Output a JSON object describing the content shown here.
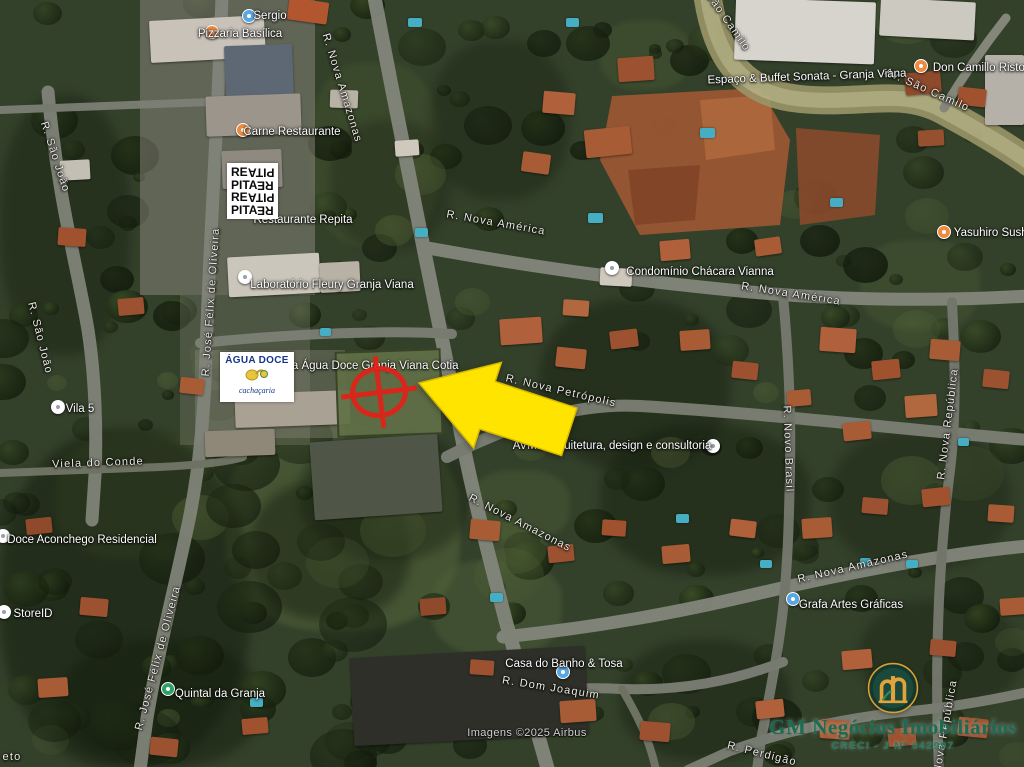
{
  "map": {
    "attribution": "Imagens ©2025 Airbus",
    "street_labels": [
      {
        "text": "R. Nova Amazonas",
        "x": 342,
        "y": 88,
        "rot": 73
      },
      {
        "text": "R. Nova América",
        "x": 496,
        "y": 223,
        "rot": 10
      },
      {
        "text": "R. Nova América",
        "x": 791,
        "y": 294,
        "rot": 9
      },
      {
        "text": "São Camilo",
        "x": 728,
        "y": 22,
        "rot": 55
      },
      {
        "text": "Av. São Camilo",
        "x": 927,
        "y": 90,
        "rot": 24
      },
      {
        "text": "R. Nova Petrópolis",
        "x": 561,
        "y": 391,
        "rot": 13
      },
      {
        "text": "R. Nova Amazonas",
        "x": 520,
        "y": 523,
        "rot": 27
      },
      {
        "text": "R. Nova Amazonas",
        "x": 853,
        "y": 567,
        "rot": -13
      },
      {
        "text": "R. Novo Brasil",
        "x": 788,
        "y": 449,
        "rot": 88
      },
      {
        "text": "R. Nova República",
        "x": 948,
        "y": 424,
        "rot": -83
      },
      {
        "text": "R. Nova República",
        "x": 944,
        "y": 735,
        "rot": -80
      },
      {
        "text": "R. São João",
        "x": 55,
        "y": 157,
        "rot": 72
      },
      {
        "text": "R. São João",
        "x": 40,
        "y": 338,
        "rot": 76
      },
      {
        "text": "Viela do Conde",
        "x": 98,
        "y": 463,
        "rot": -2
      },
      {
        "text": "R. José Félix de Oliveira",
        "x": 211,
        "y": 302,
        "rot": -86
      },
      {
        "text": "R. José Félix de Oliveira",
        "x": 158,
        "y": 658,
        "rot": -75
      },
      {
        "text": "R. Dom Joaquim",
        "x": 551,
        "y": 688,
        "rot": 9
      },
      {
        "text": "R. Perdigão",
        "x": 762,
        "y": 754,
        "rot": 14
      },
      {
        "text": "eto",
        "x": 12,
        "y": 757,
        "rot": 0
      }
    ],
    "poi_labels": [
      {
        "text": "Sergio",
        "tx": 270,
        "ty": 16,
        "icon": "blue",
        "ix": 249,
        "iy": 16
      },
      {
        "text": "Pizzaria Basílica",
        "tx": 240,
        "ty": 34,
        "icon": "orange",
        "ix": 212,
        "iy": 32
      },
      {
        "text": "Carne Restaurante",
        "tx": 292,
        "ty": 132,
        "icon": "orange",
        "ix": 243,
        "iy": 130
      },
      {
        "text": "Restaurante Repita",
        "tx": 303,
        "ty": 220
      },
      {
        "text": "Laboratório Fleury Granja Viana",
        "tx": 332,
        "ty": 285,
        "icon": "white",
        "ix": 245,
        "iy": 277
      },
      {
        "text": "Condomínio Chácara Vianna",
        "tx": 700,
        "ty": 272,
        "icon": "white",
        "ix": 612,
        "iy": 268
      },
      {
        "text": "ria Água Doce Granja Viana Cotia",
        "tx": 372,
        "ty": 366
      },
      {
        "text": "Espaço & Buffet Sonata - Granja Viana",
        "tx": 807,
        "ty": 77,
        "rot": -2
      },
      {
        "text": "Don Camillo Ristorante",
        "tx": 992,
        "ty": 68,
        "icon": "orange",
        "ix": 921,
        "iy": 66
      },
      {
        "text": "Yasuhiro Sushi",
        "tx": 992,
        "ty": 233,
        "icon": "orange",
        "ix": 944,
        "iy": 232
      },
      {
        "text": "AVMS arquitetura, design e consultoria",
        "tx": 612,
        "ty": 446,
        "icon": "white",
        "ix": 713,
        "iy": 446
      },
      {
        "text": "Vila 5",
        "tx": 80,
        "ty": 409,
        "icon": "white",
        "ix": 58,
        "iy": 407
      },
      {
        "text": "Doce Aconchego Residencial",
        "tx": 82,
        "ty": 540,
        "icon": "white",
        "ix": 3,
        "iy": 536
      },
      {
        "text": "StoreID",
        "tx": 33,
        "ty": 614,
        "icon": "white",
        "ix": 4,
        "iy": 612
      },
      {
        "text": "Quintal da Granja",
        "tx": 220,
        "ty": 694,
        "icon": "green",
        "ix": 168,
        "iy": 689
      },
      {
        "text": "Casa do Banho & Tosa",
        "tx": 564,
        "ty": 664,
        "icon": "blue",
        "ix": 563,
        "iy": 672
      },
      {
        "text": "Grafa Artes Gráficas",
        "tx": 851,
        "ty": 605,
        "icon": "blue",
        "ix": 793,
        "iy": 599
      }
    ]
  },
  "overlays": {
    "marker": {
      "color": "#e02318"
    },
    "arrow": {
      "fill": "#ffe400",
      "stroke": "#d9b800"
    }
  },
  "logos": {
    "repita": {
      "lines": [
        [
          "RE",
          "PITA"
        ],
        [
          "PITA",
          "RE"
        ],
        [
          "RE",
          "PITA"
        ],
        [
          "PITA",
          "RE"
        ]
      ]
    },
    "agua_doce": {
      "title": "ÁGUA DOCE",
      "subtitle": "cachaçaria"
    },
    "gm": {
      "name": "GM Negócios Imobiliários",
      "creci": "CRECI - J Nº 042997",
      "green": "#1d6b50",
      "gold": "#e2a33b"
    }
  }
}
